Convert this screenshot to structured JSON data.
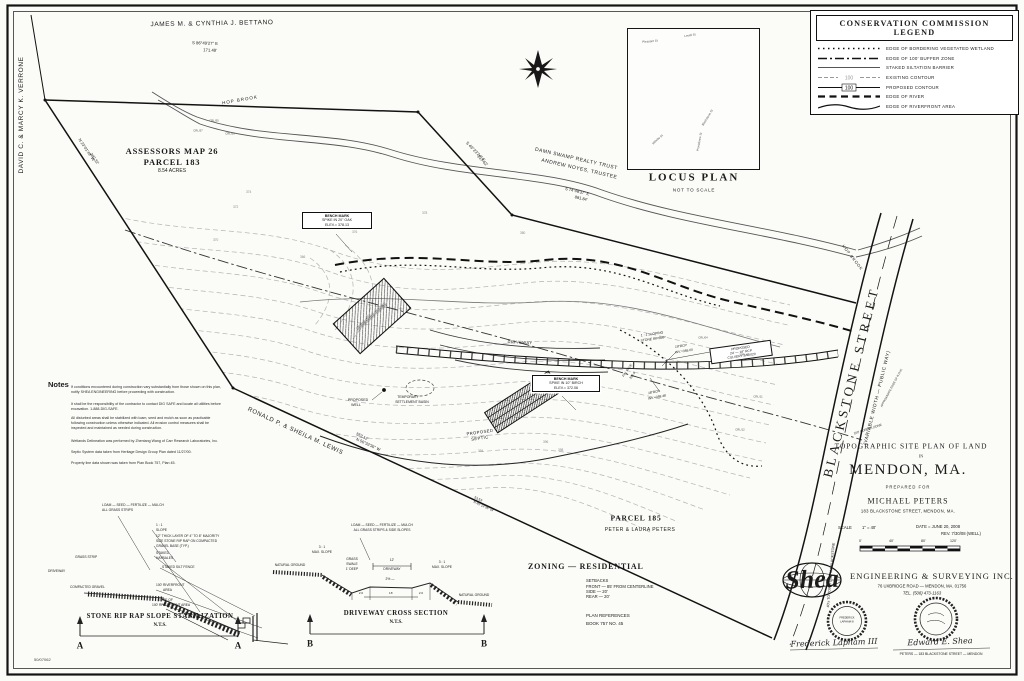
{
  "sheet": {
    "number": "50/07062"
  },
  "legend": {
    "title": "CONSERVATION COMMISSION LEGEND",
    "items": [
      {
        "label": "EDGE OF BORDERING VEGETATED WETLAND"
      },
      {
        "label": "EDGE OF 100' BUFFER ZONE"
      },
      {
        "label": "STAKED SILTATION BARRIER"
      },
      {
        "label": "EXISTING CONTOUR",
        "tag": "100"
      },
      {
        "label": "PROPOSED CONTOUR",
        "tag": "100"
      },
      {
        "label": "EDGE OF RIVER"
      },
      {
        "label": "EDGE OF RIVERFRONT AREA"
      }
    ]
  },
  "locus": {
    "title": "LOCUS PLAN",
    "subtitle": "NOT TO SCALE",
    "streets": [
      "Pleasant St",
      "Lovell St",
      "Blackstone St",
      "Providence St",
      "Millville St"
    ]
  },
  "abutters": {
    "north": "JAMES M. & CYNTHIA J. BETTANO",
    "west": "DAVID C. & MARCY K. VERRONE",
    "northeast_1": "DAMN SWAMP REALTY TRUST",
    "northeast_2": "ANDREW NOYES, TRUSTEE",
    "south": "RONALD P. & SHEILA M. LEWIS",
    "parcel185": "PARCEL 185",
    "parcel185_owner": "PETER & LAURA PETERS"
  },
  "bearings": {
    "north": {
      "bearing": "S 86°49'27\" E",
      "distance": "171.48'"
    },
    "west": {
      "bearing": "N 23°01'49\" W",
      "distance": "202.32'"
    },
    "northeast": {
      "bearing": "S 46°23'24\" E",
      "distance": "137.62'"
    },
    "swamp": {
      "bearing": "S 74°48'37\" E",
      "distance": "881.84'"
    },
    "south": {
      "bearing": "N 56°33'36\" W",
      "distance": "553.12'"
    },
    "south2": {
      "bearing": "N 65°14'36\" W",
      "distance": "53.53'"
    }
  },
  "parcel": {
    "line1": "ASSESSORS MAP 26",
    "line2": "PARCEL 183",
    "line3": "8.54 ACRES"
  },
  "features": {
    "hop_brook": "HOP BROOK",
    "street_name": "BLACKSTONE STREET",
    "street_sub": "(VARIABLE WIDTH — PUBLIC WAY)",
    "buffer_zone": "100' BUFFER ZONE",
    "row_edge": "APPROXIMATE EDGE OF R.O.W.",
    "town_line": "40'± TO TOWN LINE VIA BLACKSTONE",
    "driveway": "DRIVEWAY",
    "proposed_house": "PROPOSED HOUSE",
    "septic_1": "PROPOSED",
    "septic_2": "SEPTIC",
    "well_1": "PROPOSED",
    "well_2": "WELL",
    "basin_1": "TEMPORARY",
    "basin_2": "SETTLEMENT BASIN",
    "riprap_1": "1 : 1 SLOPING",
    "riprap_2": "STONE RIPRAP",
    "rcp1_1": "18\"RCP",
    "rcp1_2": "INV.=359.00",
    "culvert_1": "PROPOSED",
    "culvert_2": "24' — 18\" RCP",
    "culvert_3": "CULVERT S=0.020",
    "fin_pave_1": "FIN. PAVE",
    "fin_pave_2": "361.6",
    "rcp2_1": "18\"RCP",
    "rcp2_2": "INV.=358.48"
  },
  "benchmarks": {
    "bm1": {
      "l1": "BENCH MARK",
      "l2": "SPIKE IN 20\" OAK",
      "l3": "ELEV.= 378.13"
    },
    "bm2": {
      "l1": "BENCH MARK",
      "l2": "SPIKE IN 10\" BIRCH",
      "l3": "ELEV.= 372.06"
    }
  },
  "flags": [
    "CRL/55",
    "CRL/57",
    "CRL/59",
    "CRL/04",
    "CRL/08",
    "CRL/11",
    "CRL/12"
  ],
  "contours": [
    "374",
    "372",
    "370",
    "366",
    "376",
    "378",
    "380",
    "394",
    "396",
    "398"
  ],
  "notes": {
    "heading": "Notes",
    "paragraphs": [
      "If conditions encountered during construction vary substantially from those shown on this plan, notify SHEA ENGINEERING before proceeding with construction.",
      "It shall be the responsibility of the contractor to contact DIG SAFE and locate all utilities before excavation.  1-888-DIG-SAFE.",
      "All disturbed areas shall be stabilized with loam, seed and mulch as soon as practicable following construction unless otherwise indicated.  All erosion control measures shall be inspected and maintained as needed during construction.",
      "Wetlands Delineation was performed by Zhentang Wang of Carr Research Laboratories, Inc.",
      "Septic System data taken from Heritage Design Group Plan dated 11/27/00.",
      "Property line data shown was taken from Plan Book 757, Plan 45."
    ]
  },
  "detail_a": {
    "loam_1": "LOAM — SEED — FERTILIZE — MULCH",
    "loam_2": "ALL GRASS STRIPS",
    "grass_strip": "GRASS STRIP",
    "driveway": "DRIVEWAY",
    "compacted": "COMPACTED GRAVEL",
    "slope_1": "1 : 1",
    "slope_2": "SLOPE",
    "riprap_1": "12\" THICK LAYER OF 4\" TO 8\" MAJORITY",
    "riprap_2": "SIZE STONE RIP RAP ON COMPACTED",
    "riprap_3": "GRAVEL BASE (TYP.)",
    "haybales_1": "STAKED",
    "haybales_2": "HAYBALES",
    "silt_fence": "STAKED SILT FENCE",
    "riverfront_1": "100' RIVERFRONT",
    "riverfront_2": "AREA",
    "edge_1": "EDGE OF",
    "edge_2": "100' RIVERFRONT AREA",
    "title": "STONE RIP RAP SLOPE STABILIZATION",
    "nts": "N.T.S.",
    "marker": "A"
  },
  "detail_b": {
    "loam_1": "LOAM — SEED — FERTILIZE — MULCH",
    "loam_2": "ALL GRASS STRIPS & SIDE SLOPES",
    "slope_1": "3 : 1",
    "slope_2": "MAX. SLOPE",
    "natural": "NATURAL GROUND",
    "swale_1": "GRASS",
    "swale_2": "SWALE",
    "swale_3": "1' DEEP",
    "width_1": "12'",
    "width_2": "DRIVEWAY",
    "grade": "2% —",
    "dim_l": "2.0",
    "dim_m": "16'",
    "dim_r": "2.0",
    "title": "DRIVEWAY CROSS SECTION",
    "nts": "N.T.S.",
    "marker": "B"
  },
  "zoning": {
    "heading": "ZONING   —   RESIDENTIAL",
    "setbacks_title": "SETBACKS",
    "setbacks": [
      "FRONT — 85' FROM CENTERLINE",
      "SIDE — 20'",
      "REAR — 20'"
    ],
    "refs_title": "PLAN REFERENCES",
    "refs": "BOOK 757 NO. 45"
  },
  "titleblock": {
    "line1": "TOPOGRAPHIC SITE PLAN OF LAND",
    "line2": "IN",
    "line3": "MENDON, MA.",
    "line4": "PREPARED FOR",
    "line5": "MICHAEL PETERS",
    "line6": "183 BLACKSTONE STREET, MENDON, MA.",
    "scale_label": "SCALE",
    "scale_value": "1\" = 40'",
    "date": "DATE = JUNE 20, 2008",
    "rev": "REV. 7/30/08 (WELL)",
    "ticks": [
      "0'",
      "40'",
      "80'",
      "120'"
    ]
  },
  "firm": {
    "logo": "Shea",
    "name": "ENGINEERING & SURVEYING INC.",
    "address": "76 UXBRIDGE ROAD — MENDON, MA. 01756",
    "phone": "TEL. (508) 473-1163",
    "signature1": "Frederick Lapham III",
    "signature2": "Edward E. Shea",
    "seal1_1": "FREDERICK",
    "seal1_2": "LAPHAM III",
    "footer": "PETERS — 183 BLACKSTONE STREET — MENDON"
  }
}
